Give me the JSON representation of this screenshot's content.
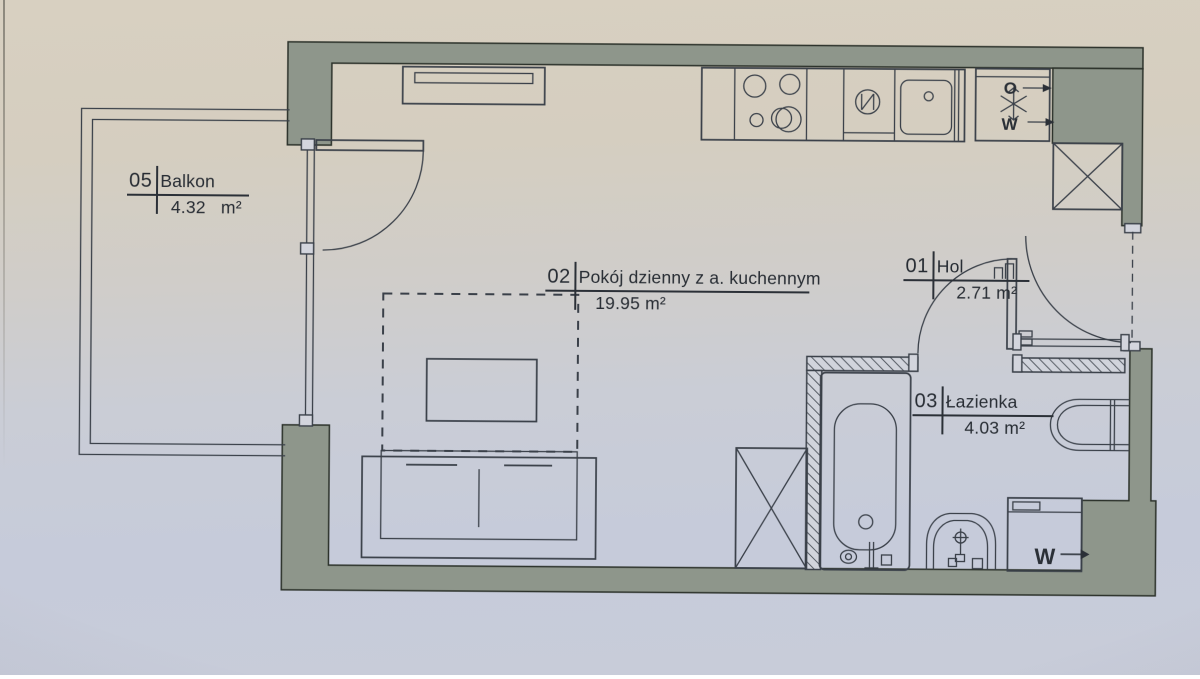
{
  "rooms": {
    "balkon": {
      "number": "05",
      "name": "Balkon",
      "area": "4.32   m²"
    },
    "living": {
      "number": "02",
      "name": "Pokój dzienny z a. kuchennym",
      "area": "19.95 m²"
    },
    "hol": {
      "number": "01",
      "name": "Hol",
      "area": "2.71 m²"
    },
    "lazienka": {
      "number": "03",
      "name": "Łazienka",
      "area": "4.03 m²"
    }
  },
  "markers": {
    "fridge_top": "O",
    "fridge_bottom": "W",
    "washer": "W"
  },
  "colors": {
    "paper_top": "#d7cfc0",
    "paper_bottom": "#c7ccdb",
    "wall": "#8e968b",
    "ink": "#3a4049",
    "text": "#272c33"
  }
}
